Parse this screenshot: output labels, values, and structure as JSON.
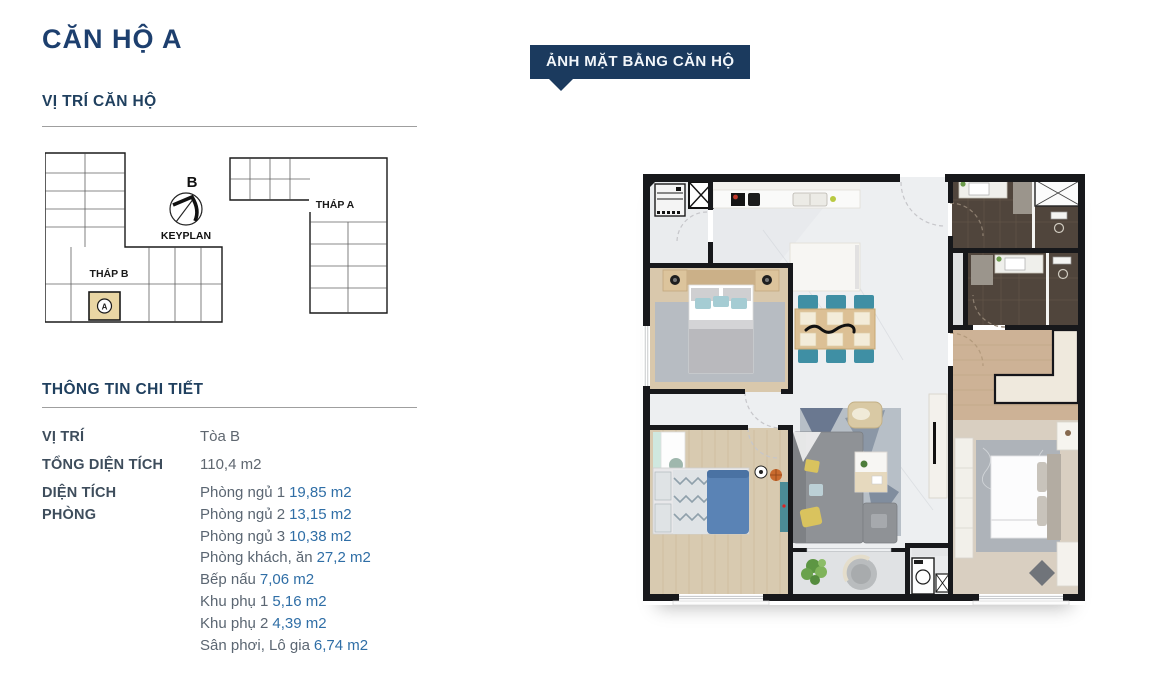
{
  "page": {
    "title": "CĂN HỘ A"
  },
  "location_section": {
    "heading": "VỊ TRÍ CĂN HỘ"
  },
  "keyplan": {
    "north_label": "B",
    "caption": "KEYPLAN",
    "tower_b_label": "THÁP B",
    "tower_a_label": "THÁP A",
    "unit_marker": "A"
  },
  "details_section": {
    "heading": "THÔNG TIN CHI TIẾT",
    "rows": [
      {
        "label": "VỊ TRÍ",
        "value": "Tòa B"
      },
      {
        "label": "TỔNG DIỆN TÍCH",
        "value": "110,4 m2"
      }
    ],
    "room_area_label_line1": "DIỆN TÍCH",
    "room_area_label_line2": "PHÒNG",
    "rooms": [
      {
        "name": "Phòng ngủ 1",
        "area": "19,85 m2"
      },
      {
        "name": "Phòng ngủ 2",
        "area": "13,15 m2"
      },
      {
        "name": "Phòng ngủ 3",
        "area": "10,38 m2"
      },
      {
        "name": "Phòng khách, ăn",
        "area": "27,2 m2"
      },
      {
        "name": "Bếp nấu",
        "area": "7,06 m2"
      },
      {
        "name": "Khu phụ 1",
        "area": "5,16 m2"
      },
      {
        "name": "Khu phụ 2",
        "area": "4,39 m2"
      },
      {
        "name": "Sân phơi, Lô gia",
        "area": "6,74 m2"
      }
    ]
  },
  "floor_plan": {
    "badge_label": "ẢNH MẶT BẰNG CĂN HỘ"
  },
  "colors": {
    "heading_navy": "#1d3f6e",
    "section_navy": "#20405f",
    "badge_bg": "#1b3a5e",
    "label_slate": "#3e4d5c",
    "value_gray": "#5f6770",
    "area_blue": "#2f6ea6",
    "keyplan_highlight": "#e9d6a4"
  }
}
